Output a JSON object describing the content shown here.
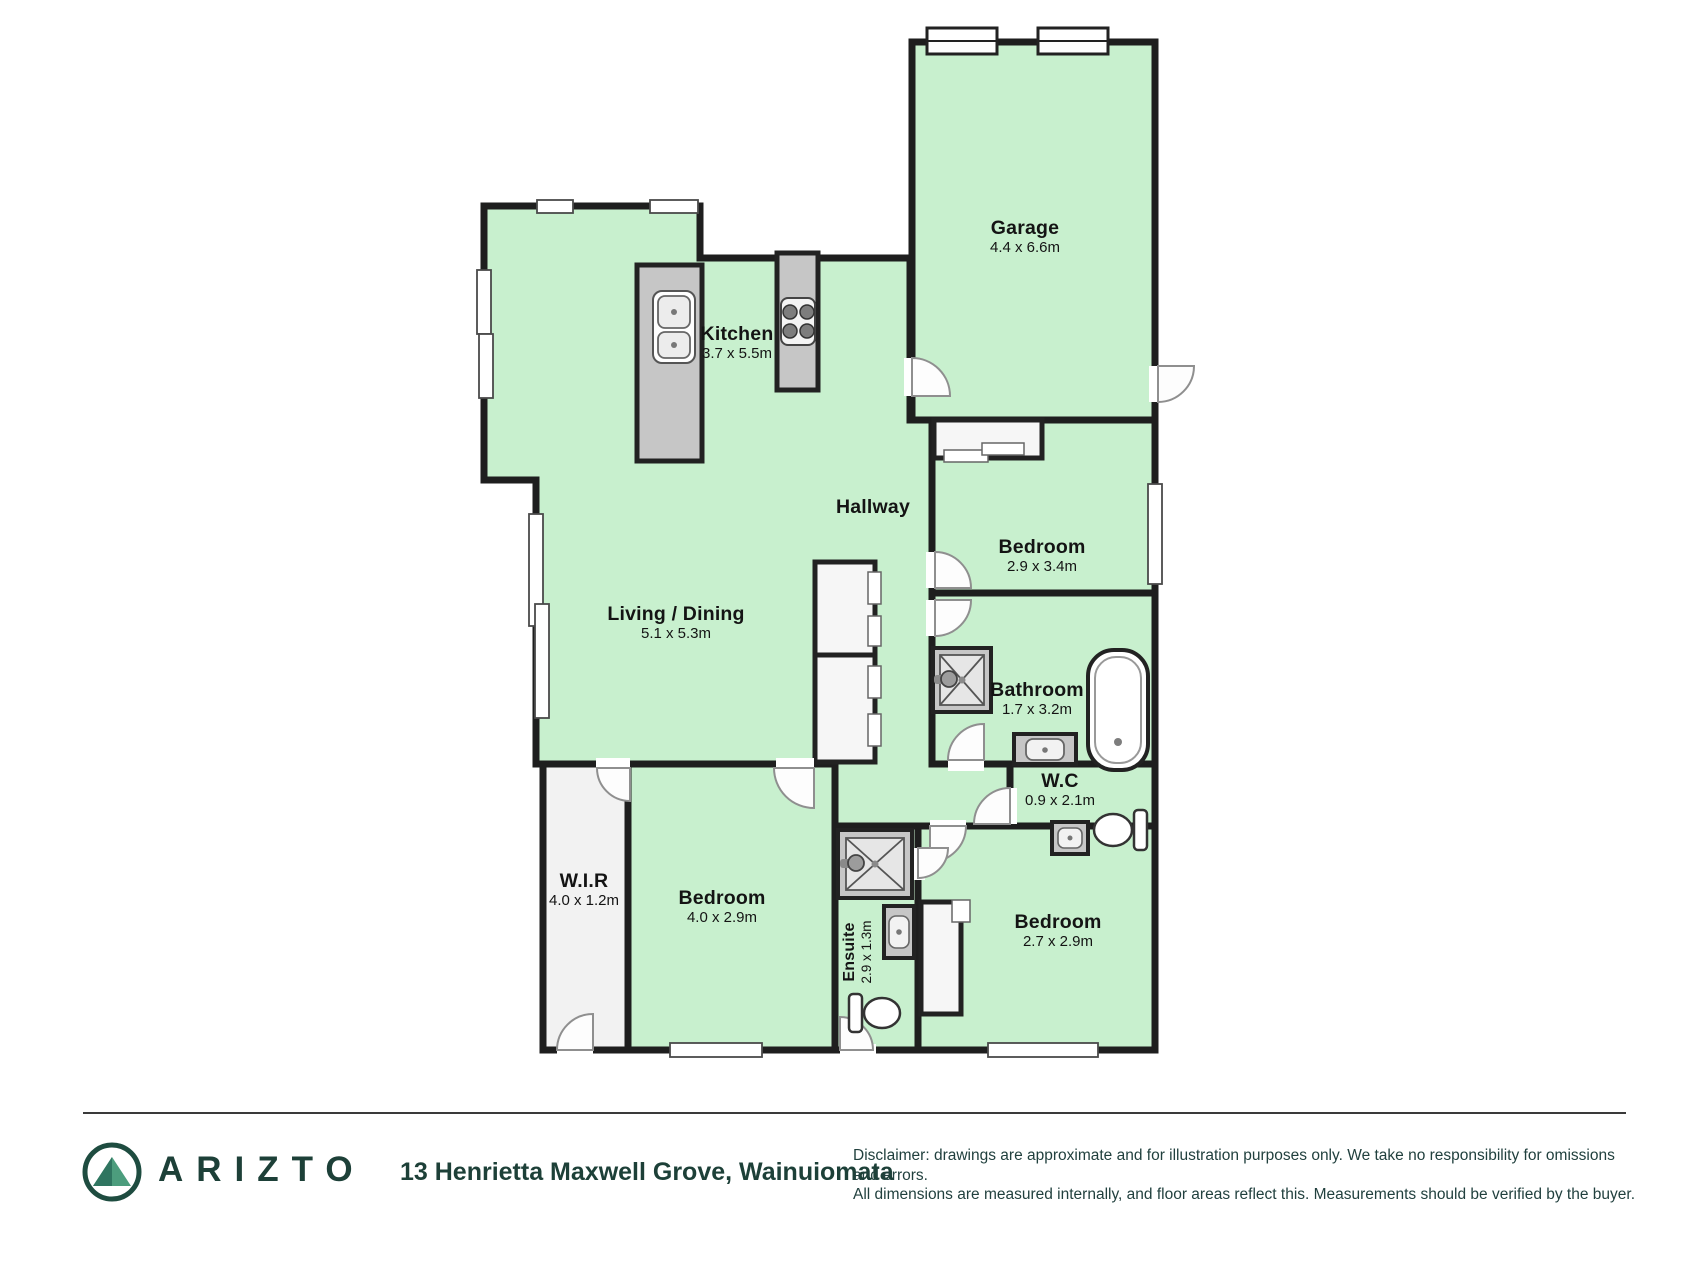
{
  "floorplan": {
    "rooms": [
      {
        "id": "garage",
        "name": "Garage",
        "dims": "4.4 x 6.6m"
      },
      {
        "id": "kitchen",
        "name": "Kitchen",
        "dims": "3.7 x 5.5m"
      },
      {
        "id": "hallway",
        "name": "Hallway",
        "dims": ""
      },
      {
        "id": "living_dining",
        "name": "Living / Dining",
        "dims": "5.1 x 5.3m"
      },
      {
        "id": "bedroom_top",
        "name": "Bedroom",
        "dims": "2.9 x 3.4m"
      },
      {
        "id": "bathroom",
        "name": "Bathroom",
        "dims": "1.7 x 3.2m"
      },
      {
        "id": "wc",
        "name": "W.C",
        "dims": "0.9 x 2.1m"
      },
      {
        "id": "wir",
        "name": "W.I.R",
        "dims": "4.0 x 1.2m"
      },
      {
        "id": "bedroom_left",
        "name": "Bedroom",
        "dims": "4.0 x 2.9m"
      },
      {
        "id": "ensuite",
        "name": "Ensuite",
        "dims": "2.9 x 1.3m"
      },
      {
        "id": "bedroom_right",
        "name": "Bedroom",
        "dims": "2.7 x 2.9m"
      }
    ],
    "colors": {
      "room_fill": "#c8f0ce",
      "wall": "#1e1e1e",
      "fixture_gray": "#c6c6c6",
      "closet_fill": "#f6f6f6"
    }
  },
  "footer": {
    "brand": "ARIZTO",
    "brand_color": "#1d4038",
    "address": "13 Henrietta Maxwell Grove, Wainuiomata",
    "disclaimer_line1": "Disclaimer: drawings are approximate and for illustration purposes only. We take no responsibility for omissions and errors.",
    "disclaimer_line2": "All dimensions are measured internally, and floor areas reflect this. Measurements should be verified by the buyer."
  }
}
